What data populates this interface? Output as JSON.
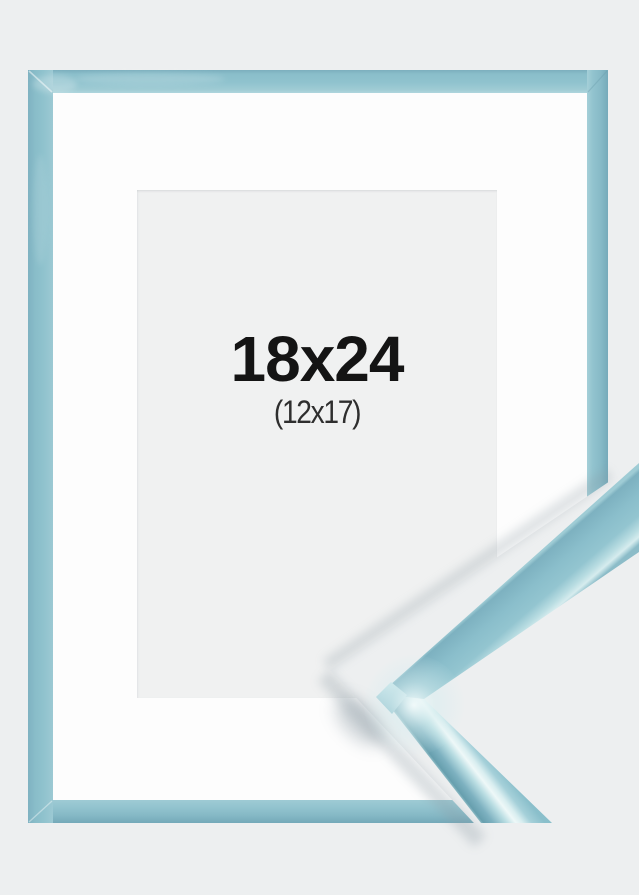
{
  "product_image": {
    "size_label": "18x24",
    "inner_size_label": "(12x17)"
  },
  "colors": {
    "background": "#edeff0",
    "frame_base": "#8ec1cd",
    "frame_dark": "#74a9b9",
    "frame_light": "#aed6dd",
    "mat": "#fdfdfd",
    "picture_area": "#f0f1f1",
    "label_primary": "#141414",
    "label_secondary": "#2e2e2e",
    "gloss_highlight": "#eef8f8",
    "sample_dark_band": "#679fae",
    "shadow": "#8b9aa3"
  }
}
